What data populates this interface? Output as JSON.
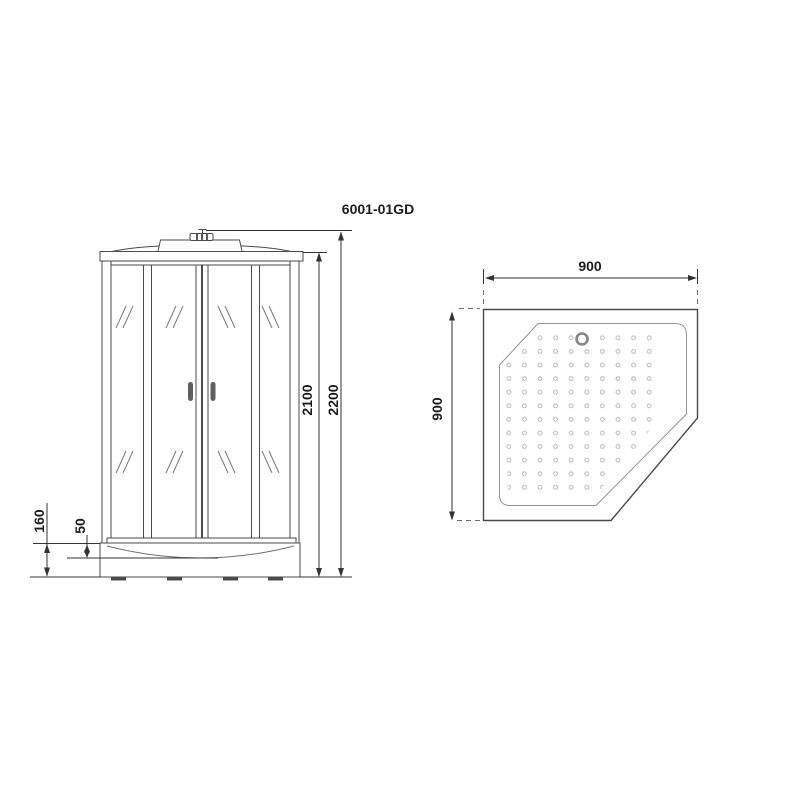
{
  "title": "6001-01GD",
  "front_view": {
    "label": "front elevation of shower cabin",
    "dims": {
      "overall_height": "2200",
      "cabin_height": "2100",
      "tray_height": "160",
      "tray_inner_depth": "50"
    }
  },
  "top_view": {
    "label": "top view of pentagonal shower tray",
    "dims": {
      "width": "900",
      "depth": "900"
    },
    "drain": "drain-ring-icon",
    "surface": "anti-slip-dot-pattern"
  },
  "colors": {
    "background": "#ffffff",
    "drawing_line": "#4a4a4a",
    "dimension_line": "#333333",
    "inner_tray_line": "#949494",
    "dimension_text": "#1c1c1c",
    "handle": "#5f5f5f",
    "dot_pattern": "#c2c2c2",
    "drain_ring": "#868686",
    "feet": "#4a4a4a"
  }
}
